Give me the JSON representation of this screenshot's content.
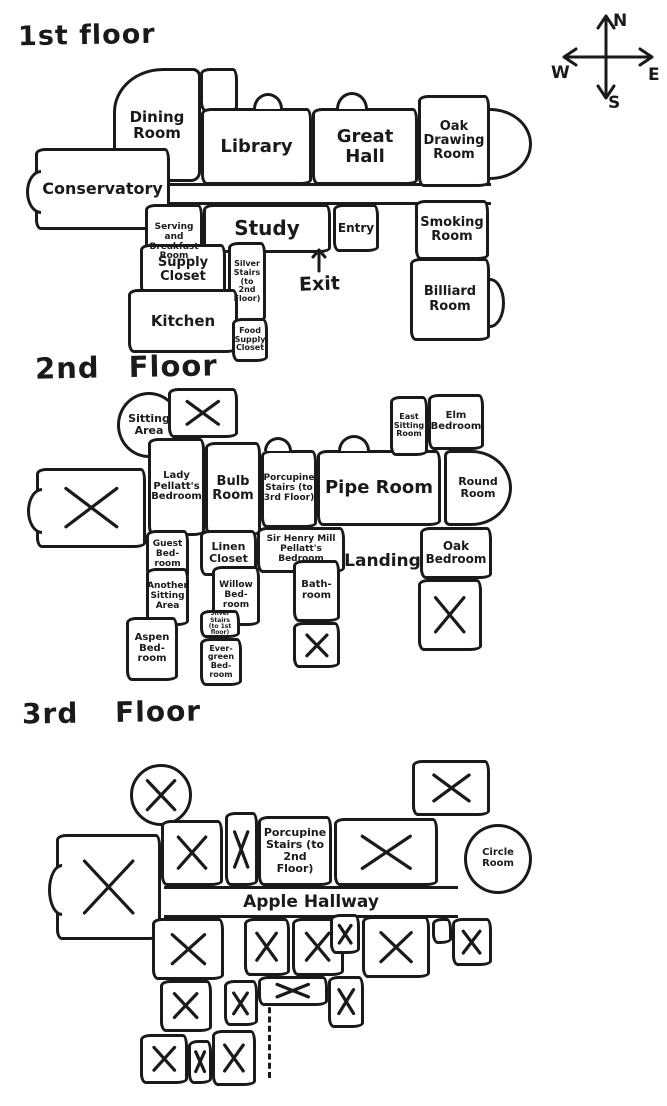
{
  "meta": {
    "ink": "#1a1a1a",
    "background": "#ffffff"
  },
  "compass": {
    "north": "N",
    "east": "E",
    "south": "S",
    "west": "W"
  },
  "floors": [
    {
      "title": "1st floor",
      "corridors": [
        {
          "x": 170,
          "y": 183,
          "w": 321,
          "h": 22
        }
      ],
      "bumps": [
        {
          "x": 253,
          "y": 93,
          "w": 30,
          "h": 16
        },
        {
          "x": 336,
          "y": 92,
          "w": 32,
          "h": 17
        }
      ],
      "rooms": [
        {
          "label": "",
          "x": 200,
          "y": 68,
          "w": 38,
          "h": 44
        },
        {
          "label": "Dining Room",
          "x": 113,
          "y": 68,
          "w": 88,
          "h": 114,
          "fs": 15,
          "shape": "tl-big"
        },
        {
          "label": "Library",
          "x": 201,
          "y": 108,
          "w": 111,
          "h": 77,
          "fs": 18
        },
        {
          "label": "Great Hall",
          "x": 312,
          "y": 108,
          "w": 106,
          "h": 77,
          "fs": 18
        },
        {
          "label": "Oak Drawing Room",
          "x": 418,
          "y": 95,
          "w": 72,
          "h": 92,
          "fs": 13,
          "bay": {
            "side": "right",
            "r": 42,
            "bh": 72
          }
        },
        {
          "label": "Conservatory",
          "x": 35,
          "y": 148,
          "w": 135,
          "h": 82,
          "fs": 16,
          "bay": {
            "side": "left",
            "r": 15,
            "bh": 44
          }
        },
        {
          "label": "Serving and Breakfast Room",
          "x": 145,
          "y": 204,
          "w": 58,
          "h": 77,
          "fs": 9
        },
        {
          "label": "Study",
          "x": 203,
          "y": 204,
          "w": 128,
          "h": 49,
          "fs": 20
        },
        {
          "label": "Entry",
          "x": 333,
          "y": 204,
          "w": 46,
          "h": 48,
          "fs": 12
        },
        {
          "label": "Smoking Room",
          "x": 415,
          "y": 200,
          "w": 74,
          "h": 60,
          "fs": 13
        },
        {
          "label": "Billiard Room",
          "x": 410,
          "y": 258,
          "w": 80,
          "h": 83,
          "fs": 13,
          "bay": {
            "side": "right",
            "r": 15,
            "bh": 50
          }
        },
        {
          "label": "Supply Closet",
          "x": 140,
          "y": 244,
          "w": 86,
          "h": 52,
          "fs": 13
        },
        {
          "label": "Silver Stairs (to 2nd Floor)",
          "x": 228,
          "y": 242,
          "w": 38,
          "h": 80,
          "fs": 8
        },
        {
          "label": "Kitchen",
          "x": 128,
          "y": 289,
          "w": 110,
          "h": 64,
          "fs": 15
        },
        {
          "label": "Food Supply Closet",
          "x": 232,
          "y": 318,
          "w": 36,
          "h": 44,
          "fs": 8
        }
      ],
      "notes": [
        {
          "label": "Exit",
          "x": 294,
          "y": 247,
          "w": 50,
          "fs": 19,
          "arrow": "up"
        }
      ]
    },
    {
      "title": "2nd Floor",
      "corridors": [],
      "bumps": [
        {
          "x": 264,
          "y": 437,
          "w": 28,
          "h": 14
        },
        {
          "x": 338,
          "y": 435,
          "w": 32,
          "h": 16
        }
      ],
      "rooms": [
        {
          "label": "Sitting Area",
          "x": 117,
          "y": 392,
          "w": 64,
          "h": 66,
          "fs": 11,
          "shape": "circle"
        },
        {
          "label": "",
          "x": 168,
          "y": 388,
          "w": 70,
          "h": 50,
          "cross": true
        },
        {
          "label": "Lady Pellatt's Bedroom",
          "x": 148,
          "y": 438,
          "w": 57,
          "h": 98,
          "fs": 10
        },
        {
          "label": "Bulb Room",
          "x": 205,
          "y": 442,
          "w": 56,
          "h": 94,
          "fs": 13
        },
        {
          "label": "Porcupine Stairs (to 3rd Floor)",
          "x": 261,
          "y": 450,
          "w": 56,
          "h": 78,
          "fs": 9
        },
        {
          "label": "Pipe Room",
          "x": 317,
          "y": 450,
          "w": 124,
          "h": 76,
          "fs": 18
        },
        {
          "label": "East Sitting Room",
          "x": 390,
          "y": 396,
          "w": 38,
          "h": 60,
          "fs": 8
        },
        {
          "label": "Elm Bedroom",
          "x": 428,
          "y": 394,
          "w": 56,
          "h": 56,
          "fs": 10
        },
        {
          "label": "Round Room",
          "x": 444,
          "y": 450,
          "w": 68,
          "h": 76,
          "fs": 11,
          "shape": "d-right"
        },
        {
          "label": "",
          "x": 36,
          "y": 468,
          "w": 110,
          "h": 80,
          "cross": true,
          "bay": {
            "side": "left",
            "r": 15,
            "bh": 46
          }
        },
        {
          "label": "Guest Bed-room",
          "x": 146,
          "y": 530,
          "w": 43,
          "h": 50,
          "fs": 9
        },
        {
          "label": "Linen Closet",
          "x": 200,
          "y": 530,
          "w": 57,
          "h": 46,
          "fs": 11
        },
        {
          "label": "Sir Henry Mill Pellatt's Bedroom",
          "x": 257,
          "y": 527,
          "w": 88,
          "h": 46,
          "fs": 9
        },
        {
          "label": "Landing",
          "x": 345,
          "y": 527,
          "w": 75,
          "h": 68,
          "fs": 17,
          "open": true
        },
        {
          "label": "Oak Bedroom",
          "x": 420,
          "y": 527,
          "w": 72,
          "h": 52,
          "fs": 12
        },
        {
          "label": "",
          "x": 418,
          "y": 579,
          "w": 64,
          "h": 72,
          "cross": true
        },
        {
          "label": "Another Sitting Area",
          "x": 146,
          "y": 568,
          "w": 43,
          "h": 58,
          "fs": 9
        },
        {
          "label": "Willow Bed-room",
          "x": 212,
          "y": 566,
          "w": 48,
          "h": 60,
          "fs": 9
        },
        {
          "label": "Bath-room",
          "x": 293,
          "y": 560,
          "w": 47,
          "h": 62,
          "fs": 10
        },
        {
          "label": "",
          "x": 293,
          "y": 622,
          "w": 47,
          "h": 46,
          "cross": true
        },
        {
          "label": "Aspen Bed-room",
          "x": 126,
          "y": 617,
          "w": 52,
          "h": 64,
          "fs": 10
        },
        {
          "label": "Silver Stairs (to 1st floor)",
          "x": 200,
          "y": 610,
          "w": 40,
          "h": 28,
          "fs": 6
        },
        {
          "label": "Ever-green Bed-room",
          "x": 200,
          "y": 638,
          "w": 42,
          "h": 48,
          "fs": 8
        }
      ],
      "notes": []
    },
    {
      "title": "3rd Floor",
      "corridors": [
        {
          "x": 164,
          "y": 886,
          "w": 294,
          "h": 32,
          "label": "Apple Hallway",
          "fs": 17
        }
      ],
      "bumps": [],
      "dashes": [
        {
          "x": 218,
          "y": 920,
          "len": 56
        },
        {
          "x": 268,
          "y": 998,
          "len": 80
        }
      ],
      "rooms": [
        {
          "label": "",
          "x": 130,
          "y": 764,
          "w": 62,
          "h": 62,
          "cross": true,
          "shape": "circle"
        },
        {
          "label": "",
          "x": 56,
          "y": 834,
          "w": 105,
          "h": 106,
          "cross": true,
          "bay": {
            "side": "left",
            "r": 14,
            "bh": 52
          }
        },
        {
          "label": "",
          "x": 161,
          "y": 820,
          "w": 62,
          "h": 66,
          "cross": true
        },
        {
          "label": "",
          "x": 225,
          "y": 812,
          "w": 33,
          "h": 74,
          "cross": true
        },
        {
          "label": "Porcupine Stairs (to 2nd Floor)",
          "x": 258,
          "y": 816,
          "w": 74,
          "h": 70,
          "fs": 11
        },
        {
          "label": "",
          "x": 334,
          "y": 818,
          "w": 104,
          "h": 68,
          "cross": true
        },
        {
          "label": "",
          "x": 412,
          "y": 760,
          "w": 78,
          "h": 56,
          "cross": true
        },
        {
          "label": "Circle Room",
          "x": 464,
          "y": 824,
          "w": 68,
          "h": 70,
          "fs": 10,
          "shape": "circle"
        },
        {
          "label": "",
          "x": 152,
          "y": 918,
          "w": 72,
          "h": 62,
          "cross": true
        },
        {
          "label": "",
          "x": 244,
          "y": 918,
          "w": 46,
          "h": 58,
          "cross": true
        },
        {
          "label": "",
          "x": 292,
          "y": 918,
          "w": 52,
          "h": 58,
          "cross": true
        },
        {
          "label": "",
          "x": 330,
          "y": 914,
          "w": 30,
          "h": 40,
          "cross": true
        },
        {
          "label": "",
          "x": 362,
          "y": 916,
          "w": 68,
          "h": 62,
          "cross": true
        },
        {
          "label": "",
          "x": 432,
          "y": 918,
          "w": 20,
          "h": 26
        },
        {
          "label": "",
          "x": 452,
          "y": 918,
          "w": 40,
          "h": 48,
          "cross": true
        },
        {
          "label": "",
          "x": 160,
          "y": 980,
          "w": 52,
          "h": 52,
          "cross": true
        },
        {
          "label": "",
          "x": 224,
          "y": 980,
          "w": 34,
          "h": 46,
          "cross": true
        },
        {
          "label": "",
          "x": 258,
          "y": 976,
          "w": 70,
          "h": 30,
          "cross": true
        },
        {
          "label": "",
          "x": 328,
          "y": 976,
          "w": 36,
          "h": 52,
          "cross": true
        },
        {
          "label": "",
          "x": 140,
          "y": 1034,
          "w": 48,
          "h": 50,
          "cross": true
        },
        {
          "label": "",
          "x": 188,
          "y": 1040,
          "w": 24,
          "h": 44,
          "cross": true
        },
        {
          "label": "",
          "x": 212,
          "y": 1030,
          "w": 44,
          "h": 56,
          "cross": true
        }
      ],
      "notes": []
    }
  ]
}
